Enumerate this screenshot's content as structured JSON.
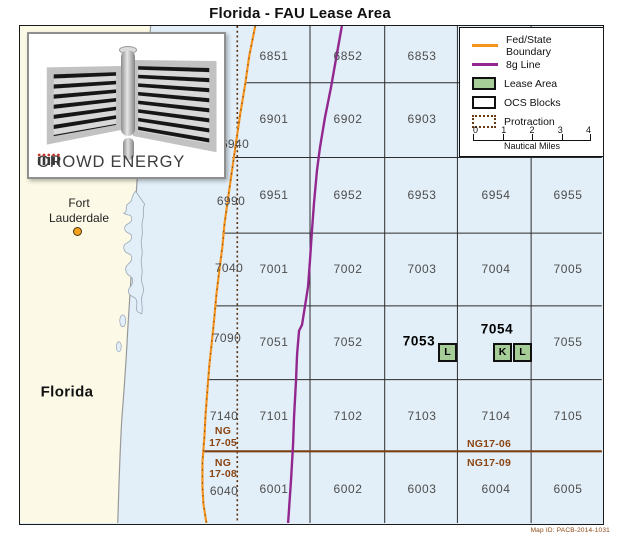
{
  "title": "Florida - FAU Lease Area",
  "map_id": "Map ID: PACB-2014-1031",
  "logo": {
    "company": "CROWD ENERGY"
  },
  "place_labels": {
    "state": "Florida",
    "city_line1": "Fort",
    "city_line2": "Lauderdale"
  },
  "legend": {
    "items": [
      {
        "label": "Fed/State Boundary",
        "symbol": "orange-line"
      },
      {
        "label": "8g Line",
        "symbol": "purple-line"
      },
      {
        "label": "Lease Area",
        "symbol": "green-box"
      },
      {
        "label": "OCS Blocks",
        "symbol": "white-box"
      },
      {
        "label": "Protraction",
        "symbol": "dashed-box"
      }
    ],
    "scale": {
      "ticks": [
        "0",
        "1",
        "2",
        "3",
        "4"
      ],
      "unit": "Nautical Miles"
    }
  },
  "grid": {
    "row1": [
      "6851",
      "6852",
      "6853"
    ],
    "row2": [
      "6901",
      "6902",
      "6903"
    ],
    "row3": [
      "6951",
      "6952",
      "6953",
      "6954",
      "6955"
    ],
    "row4": [
      "7001",
      "7002",
      "7003",
      "7004",
      "7005"
    ],
    "row5": [
      "7051",
      "7052",
      "7055"
    ],
    "row6": [
      "7101",
      "7102",
      "7103",
      "7104",
      "7105"
    ],
    "row7": [
      "6001",
      "6002",
      "6003",
      "6004",
      "6005"
    ],
    "west_labels": [
      "6940",
      "6990",
      "7040",
      "7090",
      "7140",
      "6040"
    ]
  },
  "lease": {
    "block_7053": {
      "number": "7053",
      "aliquots": [
        "L"
      ]
    },
    "block_7054": {
      "number": "7054",
      "aliquots": [
        "K",
        "L"
      ]
    }
  },
  "protraction_labels": {
    "ng1705_l1": "NG",
    "ng1705_l2": "17-05",
    "ng1708_l1": "NG",
    "ng1708_l2": "17-08",
    "ng1706": "NG17-06",
    "ng1709": "NG17-09"
  },
  "colors": {
    "water": "#e2eff8",
    "land": "#fcfae6",
    "fed_state_boundary": "#f7941e",
    "eight_g_line": "#92278f",
    "lease_area_green": "#a6cd97",
    "protraction_brown": "#7b3f12",
    "city_marker": "#f5a11c"
  }
}
